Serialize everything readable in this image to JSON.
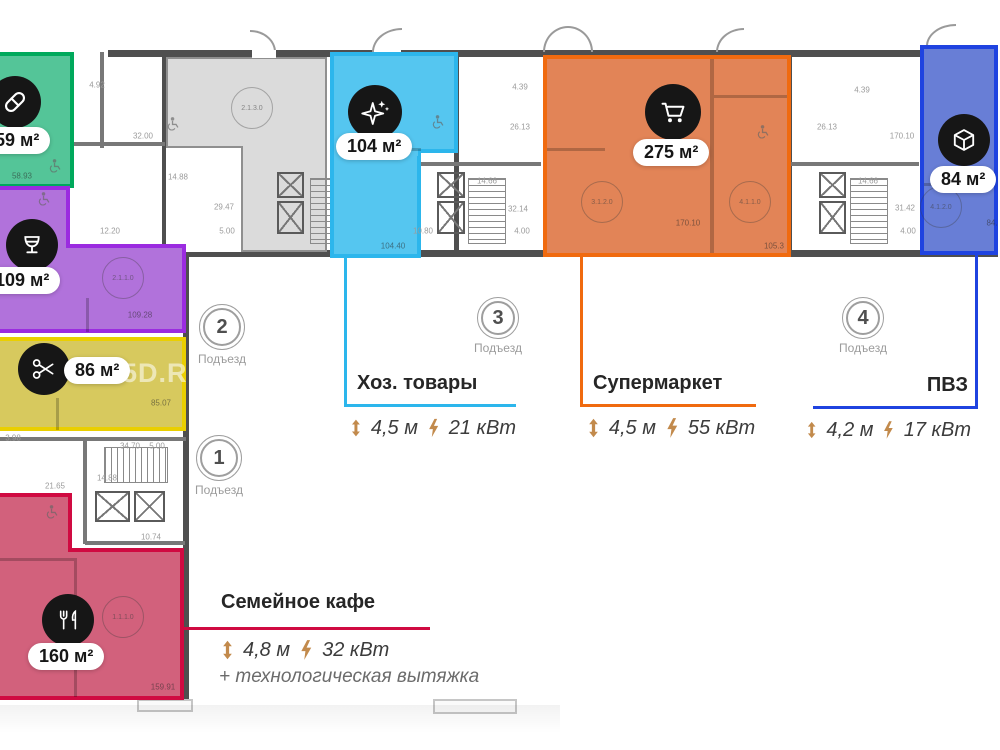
{
  "watermark": "5D.RU",
  "zones": {
    "pharmacy": {
      "area_label": "59 м²",
      "area_number": "58.93",
      "icon": "pill-icon",
      "fill": "#54C598",
      "border": "#00A95C"
    },
    "bar": {
      "area_label": "109 м²",
      "area_number": "109.28",
      "icon": "wine-glass-icon",
      "fill": "#B172DB",
      "border": "#9B2BE0"
    },
    "beauty": {
      "area_label": "86 м²",
      "area_number": "85.07",
      "icon": "scissors-icon",
      "fill": "#D7C95E",
      "border": "#EACF00"
    },
    "household": {
      "name": "Хоз. товары",
      "area_label": "104 м²",
      "area_number": "104.40",
      "ceiling_height": "4,5 м",
      "power": "21 кВт",
      "icon": "sparkles-icon",
      "fill": "#55C6F0",
      "border": "#2CB6EC"
    },
    "supermarket": {
      "name": "Супермаркет",
      "area_label": "275 м²",
      "area_numbers": [
        "170.10",
        "105.3"
      ],
      "ceiling_height": "4,5 м",
      "power": "55 кВт",
      "icon": "cart-icon",
      "fill": "#E28457",
      "border": "#F06A0F"
    },
    "pickup": {
      "name": "ПВЗ",
      "area_label": "84 м²",
      "ceiling_height": "4,2 м",
      "power": "17 кВт",
      "icon": "cube-icon",
      "fill": "#687ED6",
      "border": "#1F43E0"
    },
    "cafe": {
      "name": "Семейное кафе",
      "area_label": "160 м²",
      "area_number": "159.91",
      "ceiling_height": "4,8 м",
      "power": "32 кВт",
      "note": "+ технологическая вытяжка",
      "icon": "cutlery-icon",
      "fill": "#D2617C",
      "border": "#D00A41"
    }
  },
  "entrances": {
    "e1": {
      "number": "1",
      "label": "Подъезд"
    },
    "e2": {
      "number": "2",
      "label": "Подъезд"
    },
    "e3": {
      "number": "3",
      "label": "Подъезд"
    },
    "e4": {
      "number": "4",
      "label": "Подъезд"
    }
  },
  "plan": {
    "dimensions": [
      {
        "x": 97,
        "y": 85,
        "t": "4.92"
      },
      {
        "x": 143,
        "y": 136,
        "t": "32.00"
      },
      {
        "x": 178,
        "y": 177,
        "t": "14.88"
      },
      {
        "x": 224,
        "y": 207,
        "t": "29.47"
      },
      {
        "x": 227,
        "y": 231,
        "t": "5.00"
      },
      {
        "x": 110,
        "y": 231,
        "t": "12.20"
      },
      {
        "x": 520,
        "y": 87,
        "t": "4.39"
      },
      {
        "x": 520,
        "y": 127,
        "t": "26.13"
      },
      {
        "x": 487,
        "y": 181,
        "t": "14.66"
      },
      {
        "x": 518,
        "y": 209,
        "t": "32.14"
      },
      {
        "x": 522,
        "y": 231,
        "t": "4.00"
      },
      {
        "x": 423,
        "y": 231,
        "t": "10.80"
      },
      {
        "x": 862,
        "y": 90,
        "t": "4.39"
      },
      {
        "x": 827,
        "y": 127,
        "t": "26.13"
      },
      {
        "x": 902,
        "y": 136,
        "t": "170.10"
      },
      {
        "x": 868,
        "y": 181,
        "t": "14.66"
      },
      {
        "x": 905,
        "y": 208,
        "t": "31.42"
      },
      {
        "x": 908,
        "y": 231,
        "t": "4.00"
      },
      {
        "x": 13,
        "y": 438,
        "t": "3.98"
      },
      {
        "x": 130,
        "y": 446,
        "t": "34.70"
      },
      {
        "x": 157,
        "y": 446,
        "t": "5.00"
      },
      {
        "x": 107,
        "y": 478,
        "t": "14.88"
      },
      {
        "x": 55,
        "y": 486,
        "t": "21.65"
      },
      {
        "x": 151,
        "y": 537,
        "t": "10.74"
      }
    ],
    "room_circles": [
      {
        "x": 252,
        "y": 108,
        "id": "2.1.3.0"
      },
      {
        "x": 123,
        "y": 278,
        "id": "2.1.1.0"
      },
      {
        "x": 602,
        "y": 202,
        "id": "3.1.2.0"
      },
      {
        "x": 750,
        "y": 202,
        "id": "4.1.1.0"
      },
      {
        "x": 941,
        "y": 207,
        "id": "4.1.2.0"
      },
      {
        "x": 123,
        "y": 617,
        "id": "1.1.1.0"
      }
    ],
    "area_numbers": [
      {
        "x": 22,
        "y": 176,
        "t": "58.93"
      },
      {
        "x": 140,
        "y": 315,
        "t": "109.28"
      },
      {
        "x": 161,
        "y": 403,
        "t": "85.07"
      },
      {
        "x": 393,
        "y": 246,
        "t": "104.40"
      },
      {
        "x": 688,
        "y": 223,
        "t": "170.10"
      },
      {
        "x": 774,
        "y": 246,
        "t": "105.3"
      },
      {
        "x": 163,
        "y": 687,
        "t": "159.91"
      },
      {
        "x": 992,
        "y": 223,
        "t": "84."
      }
    ],
    "wheelchair_positions": [
      [
        55,
        168
      ],
      [
        44,
        201
      ],
      [
        173,
        126
      ],
      [
        438,
        124
      ],
      [
        763,
        134
      ],
      [
        52,
        514
      ]
    ]
  }
}
